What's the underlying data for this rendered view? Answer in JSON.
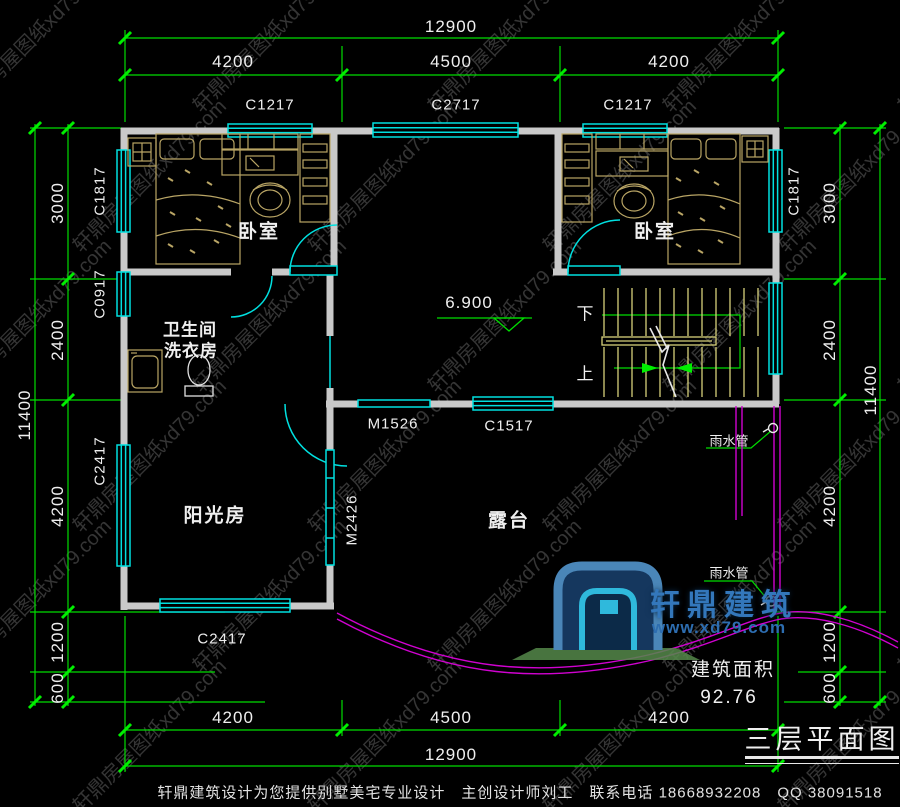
{
  "watermark": {
    "text": "轩鼎房屋图纸xd79.com"
  },
  "dimensions": {
    "top": {
      "overall": "12900",
      "segments": [
        "4200",
        "4500",
        "4200"
      ]
    },
    "bottom": {
      "overall": "12900",
      "segments": [
        "4200",
        "4500",
        "4200"
      ]
    },
    "left": {
      "overall": "11400",
      "segments": [
        "3000",
        "2400",
        "4200",
        "1200",
        "600"
      ]
    },
    "right": {
      "overall": "11400",
      "segments": [
        "3000",
        "2400",
        "4200",
        "1200",
        "600"
      ]
    }
  },
  "windows": {
    "top": [
      "C1217",
      "C2717",
      "C1217"
    ],
    "left": [
      "C1817",
      "C0917",
      "C2417"
    ],
    "right": [
      "C1817"
    ],
    "middle": [
      "C1517"
    ],
    "bottom": [
      "C2417"
    ]
  },
  "doors": {
    "hall_door": "M1526",
    "sunroom_door": "M2426"
  },
  "rooms": {
    "bedroom_left": "卧室",
    "bedroom_right": "卧室",
    "bathroom_line1": "卫生间",
    "bathroom_line2": "洗衣房",
    "sunroom": "阳光房",
    "terrace": "露台"
  },
  "stairs": {
    "down": "下",
    "up": "上"
  },
  "elevation": "6.900",
  "rain_pipe_top": "雨水管",
  "rain_pipe_bottom": "雨水管",
  "area": {
    "label": "建筑面积",
    "value": "92.76"
  },
  "title": "三层平面图",
  "logo": {
    "name": "轩鼎建筑",
    "url": "www.xd79.com"
  },
  "footer": "轩鼎建筑设计为您提供别墅美宅专业设计　主创设计师刘工　联系电话 18668932208　QQ 38091518",
  "colors": {
    "background": "#000000",
    "wall": "#c9c9c9",
    "dimension_green": "#00dd00",
    "window_door_cyan": "#00e0e0",
    "stair_yellow": "#d6d07a",
    "railing_magenta": "#d002d0",
    "furniture_tan": "#b9a565",
    "text_white": "#f0f0f0",
    "logo_blue": "#3377bb",
    "logo_cyan": "#2fb9dc",
    "logo_green": "#55884a"
  }
}
